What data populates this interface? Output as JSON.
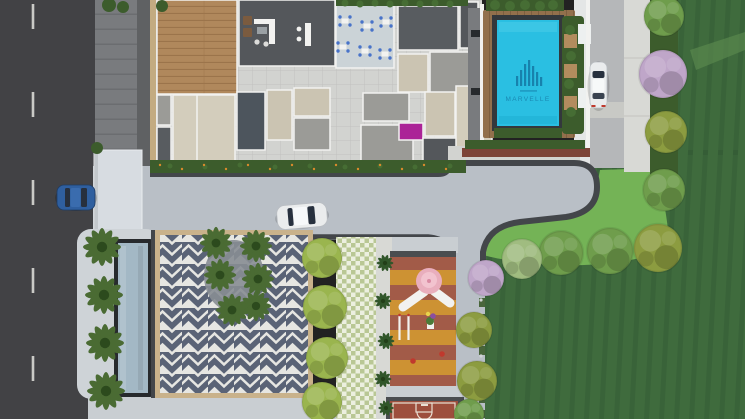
{
  "pool": {
    "logo_text": "MARVELLE",
    "logo_icon": "highrise-towers-logo"
  },
  "colors": {
    "asphalt": "#424245",
    "roadLine": "#d9d9d5",
    "sidewalk": "#797b7e",
    "sidewalkDark": "#5f6163",
    "wallTan": "#c3ab81",
    "tileFloor": "#d2d3d0",
    "tileLine": "#c1c2bf",
    "woodDeck": "#b0885c",
    "woodLine": "#9b744b",
    "terraceDark": "#54575b",
    "diningFloor": "#cbd3d7",
    "chairBlue": "#4873c9",
    "roomBeige": "#cbc4b2",
    "roomBeigeLight": "#d3cdbc",
    "roomSpeckle": "#9b9b97",
    "roomDark": "#4d555d",
    "roomGrayDark": "#585c60",
    "magentaRoom": "#ab2397",
    "poolDeckWood": "#92704c",
    "poolCoping": "#33383c",
    "poolWater": "#2abfe2",
    "poolLogo": "#1478a4",
    "planterBrown": "#b28c5e",
    "planterWhite": "#edf0f0",
    "hedgeDark": "#3c5c2c",
    "hedgeBump": "#466d34",
    "flowerOrange": "#d98a2c",
    "bedBrown": "#7d4438",
    "concrete": "#b9bfc6",
    "concreteLight": "#ced3d7",
    "pavement": "#c9ced2",
    "pavementWhite": "#e4e6e6",
    "curb": "#43464a",
    "canopy": "#d7dce1",
    "waterFeature": "#a3b8c5",
    "waterFrame": "#272a2d",
    "plazaTan": "#c9b28b",
    "plazaDark": "#5a6376",
    "plazaLight": "#e6e6e2",
    "plazaGround": "#878d93",
    "checkerGreen": "#b9c795",
    "checkerLight": "#ecefe0",
    "playMustard": "#cd9233",
    "playTerracotta": "#a25b48",
    "playBorder": "#4a4d50",
    "structWhite": "#f2f2f0",
    "structPink": "#e9aebd",
    "structPinkDeep": "#d98ba3",
    "toyRed": "#c0392d",
    "courtClay": "#9d4f3d",
    "courtLine": "#e9dfd3",
    "lawnDark": "#3f6b3d",
    "lawnRow": "#2e5230",
    "lawnBright": "#74b356",
    "trackGreen": "#5a8a4e",
    "treeGreen": "#6f9d4c",
    "treeOlive": "#8c9c40",
    "treePale": "#a0bc80",
    "treeLilac": "#bfa6c9",
    "shrubLight": "#9ab54e",
    "fernDark": "#31562a",
    "palmGreen": "#4a6b33",
    "siteRoad": "#b5b7b9",
    "siteRoadBand": "#c8c9c5",
    "walkLight": "#d8d9d5",
    "carBlue": "#2f5f9f",
    "carWhite": "#eaeced",
    "glassDark": "#27303e"
  }
}
